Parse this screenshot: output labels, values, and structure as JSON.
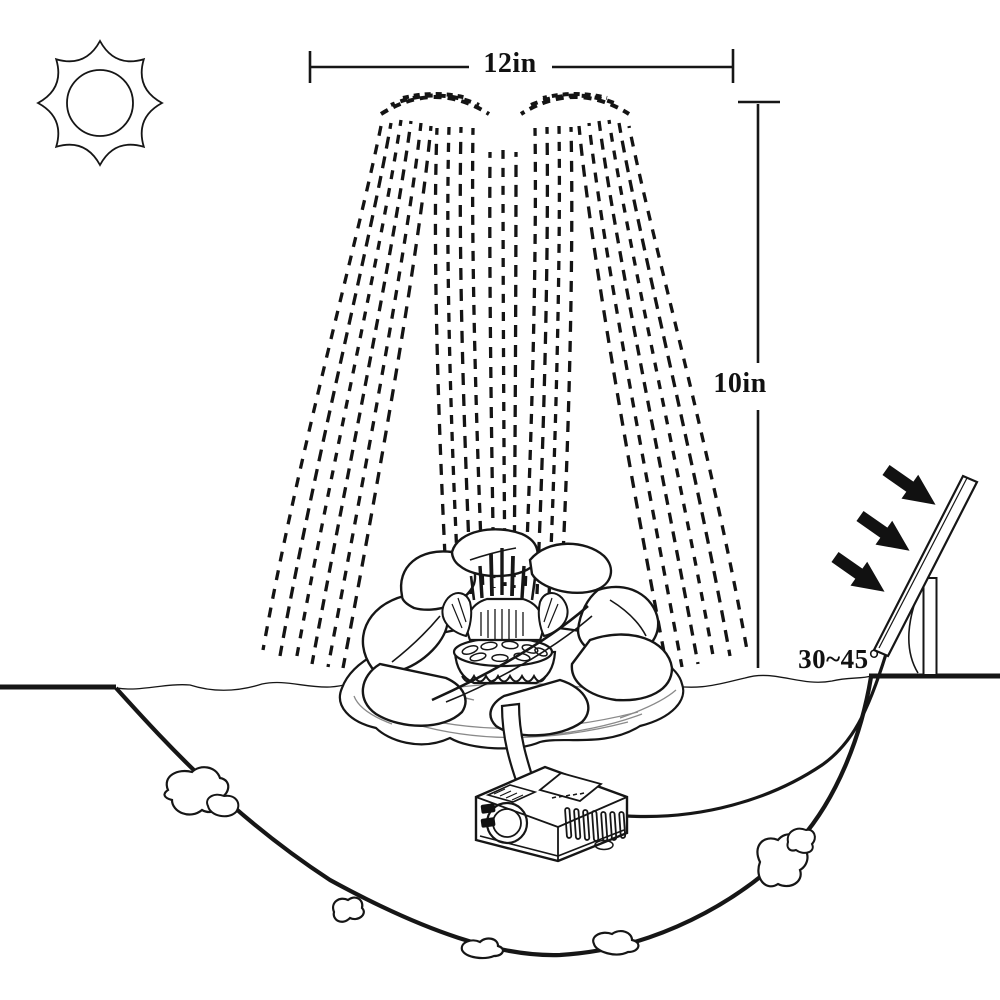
{
  "labels": {
    "spray_width": "12in",
    "spray_height": "10in",
    "panel_angle_range": "30~45°"
  },
  "colors": {
    "background": "#ffffff",
    "line": "#161616",
    "light_line": "#8a8a8a",
    "arrow_fill": "#111111"
  },
  "components": [
    "sun-icon",
    "width-dimension-line",
    "height-dimension-line",
    "water-spray",
    "lotus-flower-float",
    "fountain-nozzle",
    "water-pump",
    "connecting-tube",
    "power-cable",
    "solar-panel",
    "panel-support",
    "angle-arc",
    "sunlight-arrows",
    "pond-basin",
    "water-surface",
    "rocks"
  ]
}
